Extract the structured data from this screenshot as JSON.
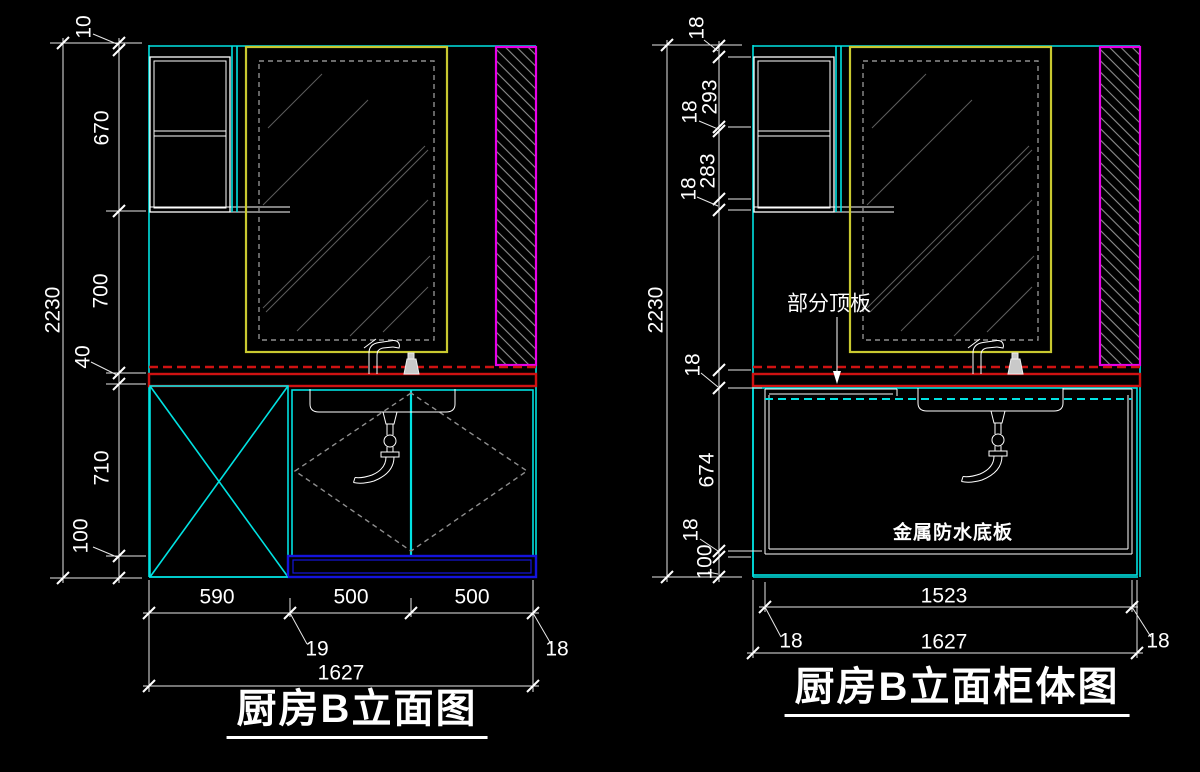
{
  "colors": {
    "background": "#000000",
    "cyan": "#00e2e2",
    "yellow": "#c9c930",
    "magenta": "#e800e8",
    "red_line": "#cf1212",
    "blue": "#1414dc",
    "white": "#ffffff"
  },
  "left": {
    "title": "厨房B立面图",
    "dims": {
      "overall_height": "2230",
      "top_gap": "10",
      "wall_cabinet": "670",
      "window_h": "700",
      "counter": "40",
      "base": "710",
      "kick": "100",
      "w1": "590",
      "w2": "500",
      "w3": "500",
      "gap": "19",
      "side": "18",
      "overall_width": "1627"
    }
  },
  "right": {
    "title": "厨房B立面柜体图",
    "notes": {
      "top_panel": "部分顶板",
      "bottom_panel": "金属防水底板"
    },
    "dims": {
      "overall_height": "2230",
      "t1": "18",
      "t2": "293",
      "t3": "18",
      "t4": "283",
      "t5": "18",
      "m1": "18",
      "m2": "674",
      "m3": "18",
      "m4": "100",
      "w1": "1523",
      "l1": "18",
      "l2": "18",
      "overall_width": "1627"
    }
  }
}
